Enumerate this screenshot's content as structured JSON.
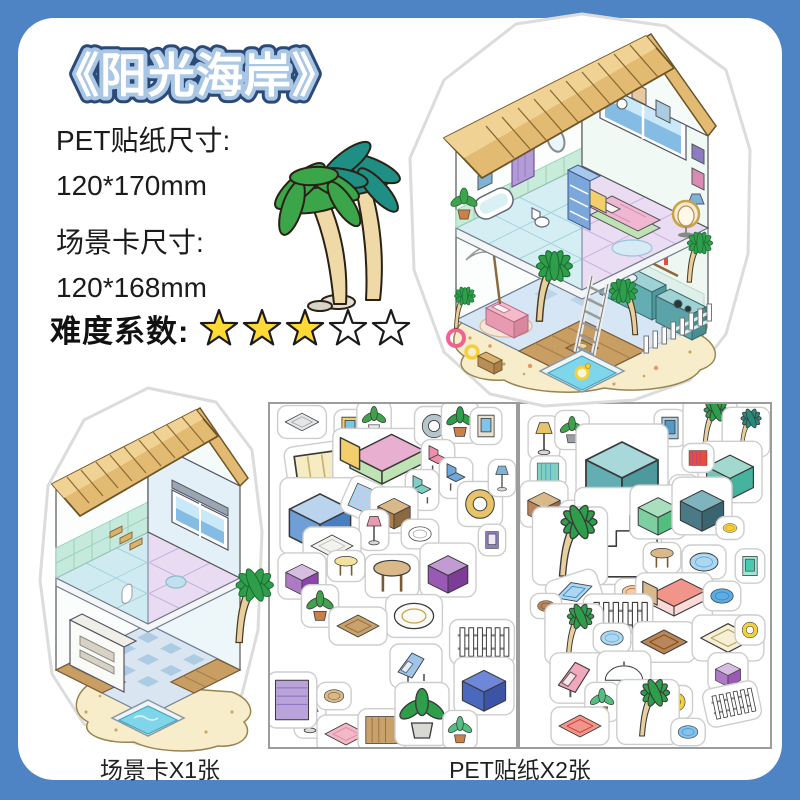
{
  "product": {
    "title": "《阳光海岸》"
  },
  "specs": [
    {
      "label": "PET贴纸尺寸:",
      "value": "120*170mm"
    },
    {
      "label": "场景卡尺寸:",
      "value": "120*168mm"
    }
  ],
  "difficulty": {
    "label": "难度系数:",
    "filled": 3,
    "total": 5
  },
  "captions": {
    "scene_card": "场景卡X1张",
    "stickers": "PET贴纸X2张"
  },
  "colors": {
    "background": "#4E84C3",
    "card": "#FFFFFF",
    "title_fill": "#FFFFFF",
    "title_stroke_dark": "#2C4A78",
    "title_stroke_light": "#A9C6E4",
    "text": "#1B1B1B",
    "star_filled": "#FFD935",
    "star_empty": "#FFFFFF",
    "star_outline": "#1A1A1A",
    "sticker_outline": "#CDCDCD",
    "sand": "#F7EDCB",
    "thatch": "#E2BA72",
    "pool_water": "#7FD6EA",
    "kitchen_teal": "#63AEB3",
    "floor_lavender": "#E9DBF2",
    "floor_cyan": "#CFEAF0"
  },
  "illustrations": {
    "main_house": "isometric-beach-house-sticker",
    "scene_card": "empty-isometric-room-card",
    "palm_deco": "twin-palm-trees"
  },
  "sheets": [
    {
      "name": "sticker-sheet-1",
      "stickers": [
        {
          "n": "hanging-shelf",
          "k": "flat",
          "x": 32,
          "y": 18,
          "s": 0.8,
          "c": [
            "#E4E6E8",
            "#9AA0A6"
          ]
        },
        {
          "n": "picture-frame",
          "k": "frame",
          "x": 80,
          "y": 24,
          "s": 0.9,
          "c": [
            "#F2CF6B",
            "#7FC4E8"
          ]
        },
        {
          "n": "potted-plant",
          "k": "plant",
          "x": 104,
          "y": 16,
          "s": 0.8,
          "c": [
            "#E8E8E4",
            "#3FA34D"
          ]
        },
        {
          "n": "window-blinds",
          "k": "stripes",
          "x": 62,
          "y": 76,
          "s": 1.9,
          "r": -8,
          "c": [
            "#F5ECC4",
            "#C9B270"
          ]
        },
        {
          "n": "double-bed",
          "k": "bed",
          "x": 112,
          "y": 56,
          "s": 1.6,
          "c": [
            "#F2CF6B",
            "#E9AFD0",
            "#BFE3B4"
          ]
        },
        {
          "n": "oval-mirror",
          "k": "ring",
          "x": 164,
          "y": 22,
          "s": 0.9,
          "c": [
            "#B8C4CC"
          ]
        },
        {
          "n": "potted-palm",
          "k": "plant",
          "x": 190,
          "y": 18,
          "s": 0.9,
          "c": [
            "#C9804A",
            "#2E9E4B"
          ]
        },
        {
          "n": "beach-painting",
          "k": "frame",
          "x": 216,
          "y": 22,
          "s": 0.9,
          "c": [
            "#E8E0D0",
            "#7FC4E8"
          ]
        },
        {
          "n": "pink-chair",
          "k": "chair",
          "x": 168,
          "y": 56,
          "s": 0.9,
          "c": [
            "#EE8FAC"
          ]
        },
        {
          "n": "tv-console",
          "k": "box",
          "x": 50,
          "y": 112,
          "s": 1.7,
          "c": [
            "#BBD4EE",
            "#6F9FD8",
            "#4A7EC2"
          ]
        },
        {
          "n": "beach-towels",
          "k": "stripes",
          "x": 96,
          "y": 96,
          "s": 0.8,
          "r": 24,
          "c": [
            "#AFD4F0",
            "#F3B8CC"
          ]
        },
        {
          "n": "kids-chair",
          "k": "chair",
          "x": 152,
          "y": 86,
          "s": 0.9,
          "c": [
            "#7FCFC4"
          ]
        },
        {
          "n": "blue-armchair",
          "k": "chair",
          "x": 186,
          "y": 74,
          "s": 0.9,
          "c": [
            "#6FA8DC"
          ]
        },
        {
          "n": "hanging-egg-chair",
          "k": "ring",
          "x": 210,
          "y": 100,
          "s": 1.1,
          "c": [
            "#E8C36A"
          ]
        },
        {
          "n": "storage-shelf",
          "k": "box",
          "x": 124,
          "y": 106,
          "s": 0.9,
          "c": [
            "#D9B98A",
            "#A87F4D",
            "#8A6A3E"
          ]
        },
        {
          "n": "pink-lamp",
          "k": "lamp",
          "x": 104,
          "y": 126,
          "s": 0.8,
          "c": [
            "#E89BB0"
          ]
        },
        {
          "n": "toilet",
          "k": "round",
          "x": 150,
          "y": 130,
          "s": 0.8,
          "c": [
            "#FFFFFF",
            "#9AA0A6"
          ]
        },
        {
          "n": "white-rug",
          "k": "flat",
          "x": 62,
          "y": 142,
          "s": 1.0,
          "c": [
            "#F2F2EE",
            "#B9BDB9"
          ]
        },
        {
          "n": "wall-art",
          "k": "frame",
          "x": 222,
          "y": 136,
          "s": 0.7,
          "c": [
            "#8E7CC3",
            "#EDE7F6"
          ]
        },
        {
          "n": "blue-lamp",
          "k": "lamp",
          "x": 232,
          "y": 74,
          "s": 0.7,
          "c": [
            "#7FB3D5"
          ]
        },
        {
          "n": "yellow-stool",
          "k": "table",
          "x": 76,
          "y": 162,
          "s": 0.8,
          "c": [
            "#F2E2A0"
          ]
        },
        {
          "n": "round-table",
          "k": "table",
          "x": 122,
          "y": 172,
          "s": 1.3,
          "c": [
            "#D9B98A"
          ]
        },
        {
          "n": "purple-table",
          "k": "box",
          "x": 178,
          "y": 166,
          "s": 1.1,
          "c": [
            "#C39BD3",
            "#9B59B6",
            "#7D3C98"
          ]
        },
        {
          "n": "purple-cabinet",
          "k": "box",
          "x": 32,
          "y": 172,
          "s": 0.9,
          "c": [
            "#D7BDE2",
            "#AF7AC5",
            "#8E44AD"
          ]
        },
        {
          "n": "green-plant",
          "k": "plant",
          "x": 50,
          "y": 202,
          "s": 0.9,
          "c": [
            "#C9804A",
            "#3FA34D"
          ]
        },
        {
          "n": "bathtub",
          "k": "round",
          "x": 144,
          "y": 212,
          "s": 1.4,
          "c": [
            "#FBFBF8",
            "#C9A24A"
          ]
        },
        {
          "n": "wall-shelf-long",
          "k": "flat",
          "x": 88,
          "y": 222,
          "s": 1.0,
          "c": [
            "#C9A26B",
            "#8A6A3E"
          ]
        },
        {
          "n": "garden-fence",
          "k": "fence",
          "x": 212,
          "y": 238,
          "s": 1.1,
          "c": [
            "#FFFFFF"
          ]
        },
        {
          "n": "deck-chair",
          "k": "lounge",
          "x": 146,
          "y": 262,
          "s": 1.0,
          "c": [
            "#9FC5E8"
          ]
        },
        {
          "n": "grand-piano",
          "k": "box",
          "x": 214,
          "y": 282,
          "s": 1.2,
          "c": [
            "#6F87D8",
            "#4A69BD",
            "#3B54A5"
          ]
        },
        {
          "n": "pedestal-sink",
          "k": "lamp",
          "x": 40,
          "y": 312,
          "s": 0.9,
          "c": [
            "#FFFFFF"
          ]
        },
        {
          "n": "purple-curtain",
          "k": "stripes",
          "x": 22,
          "y": 296,
          "s": 1.1,
          "r": 90,
          "c": [
            "#B9A3D8",
            "#8E6FC0"
          ]
        },
        {
          "n": "pink-rug",
          "k": "flat",
          "x": 76,
          "y": 330,
          "s": 1.0,
          "c": [
            "#F2B8C6",
            "#D88AA0"
          ]
        },
        {
          "n": "bookshelf",
          "k": "stripes",
          "x": 112,
          "y": 326,
          "s": 0.9,
          "c": [
            "#C9A26B",
            "#8A6A3E"
          ]
        },
        {
          "n": "large-plant",
          "k": "plant",
          "x": 152,
          "y": 310,
          "s": 1.5,
          "c": [
            "#D9D9D4",
            "#2E9E4B"
          ]
        },
        {
          "n": "small-tree",
          "k": "plant",
          "x": 190,
          "y": 326,
          "s": 0.8,
          "c": [
            "#C9804A",
            "#52BE80"
          ]
        },
        {
          "n": "storage-basket",
          "k": "round",
          "x": 64,
          "y": 292,
          "s": 0.7,
          "c": [
            "#D9B98A",
            "#8A6A3E"
          ]
        }
      ]
    },
    {
      "name": "sticker-sheet-2",
      "stickers": [
        {
          "n": "table-lamp",
          "k": "lamp",
          "x": 24,
          "y": 34,
          "s": 0.9,
          "c": [
            "#E8C36A"
          ]
        },
        {
          "n": "small-plant",
          "k": "plant",
          "x": 52,
          "y": 26,
          "s": 0.8,
          "c": [
            "#9AA0A6",
            "#3FA34D"
          ]
        },
        {
          "n": "bottle-rack",
          "k": "stripes",
          "x": 28,
          "y": 68,
          "s": 0.6,
          "c": [
            "#7FCFC4",
            "#2E86C1"
          ]
        },
        {
          "n": "blue-frame",
          "k": "frame",
          "x": 150,
          "y": 24,
          "s": 0.9,
          "c": [
            "#A9CCE3",
            "#5499C7"
          ]
        },
        {
          "n": "palm-tree-a",
          "k": "palm",
          "x": 190,
          "y": 22,
          "s": 1.0,
          "c": [
            "#E7CF9E",
            "#2E9E4B"
          ]
        },
        {
          "n": "palm-tree-b",
          "k": "palm",
          "x": 226,
          "y": 28,
          "s": 0.85,
          "c": [
            "#E7CF9E",
            "#27897B"
          ]
        },
        {
          "n": "kitchen-counter",
          "k": "box",
          "x": 102,
          "y": 64,
          "s": 2.0,
          "c": [
            "#A8D8DA",
            "#63AEB3",
            "#4E999E"
          ]
        },
        {
          "n": "gray-frame",
          "k": "frame",
          "x": 164,
          "y": 88,
          "s": 0.8,
          "c": [
            "#D5D8DC",
            "#808B96"
          ]
        },
        {
          "n": "teal-sideboard",
          "k": "box",
          "x": 210,
          "y": 68,
          "s": 1.3,
          "c": [
            "#A2D9CE",
            "#73C6B6",
            "#45B39D"
          ]
        },
        {
          "n": "spice-bottles",
          "k": "stripes",
          "x": 178,
          "y": 54,
          "s": 0.5,
          "c": [
            "#E74C3C",
            "#8E44AD"
          ]
        },
        {
          "n": "serving-cart",
          "k": "box",
          "x": 24,
          "y": 100,
          "s": 0.9,
          "c": [
            "#D9B98A",
            "#B9855C",
            "#9A6A44"
          ]
        },
        {
          "n": "wood-crates",
          "k": "flat",
          "x": 66,
          "y": 114,
          "s": 0.9,
          "c": [
            "#D9B36B",
            "#8A6A3E"
          ]
        },
        {
          "n": "staircase",
          "k": "stairs",
          "x": 98,
          "y": 132,
          "s": 1.7,
          "c": [
            "#FFFFFF"
          ]
        },
        {
          "n": "kitchen-stove",
          "k": "box",
          "x": 138,
          "y": 108,
          "s": 1.1,
          "c": [
            "#A9DFBF",
            "#7DCEA0",
            "#52BE80"
          ]
        },
        {
          "n": "refrigerator",
          "k": "box",
          "x": 182,
          "y": 102,
          "s": 1.2,
          "c": [
            "#7FB3BE",
            "#4A7A86",
            "#3A6470"
          ]
        },
        {
          "n": "kettle",
          "k": "round",
          "x": 210,
          "y": 124,
          "s": 0.5,
          "c": [
            "#F4D03F",
            "#B7950B"
          ]
        },
        {
          "n": "tall-palm",
          "k": "palm",
          "x": 50,
          "y": 142,
          "s": 1.5,
          "c": [
            "#E7CF9E",
            "#2E9E4B"
          ]
        },
        {
          "n": "bar-stool",
          "k": "table",
          "x": 142,
          "y": 154,
          "s": 0.8,
          "c": [
            "#D9B98A"
          ]
        },
        {
          "n": "vanity-stool",
          "k": "round",
          "x": 184,
          "y": 158,
          "s": 1.0,
          "c": [
            "#AED6F1",
            "#5DADE2"
          ]
        },
        {
          "n": "mint-frame",
          "k": "frame",
          "x": 230,
          "y": 162,
          "s": 0.8,
          "c": [
            "#A3E4D7",
            "#48C9B0"
          ]
        },
        {
          "n": "surfboard",
          "k": "flat",
          "x": 54,
          "y": 188,
          "s": 0.9,
          "r": -18,
          "c": [
            "#AED6F1",
            "#2E86C1"
          ]
        },
        {
          "n": "pet-bed",
          "k": "round",
          "x": 112,
          "y": 188,
          "s": 0.7,
          "c": [
            "#F5CBA7",
            "#AF601A"
          ]
        },
        {
          "n": "day-bed",
          "k": "bed",
          "x": 154,
          "y": 194,
          "s": 1.2,
          "c": [
            "#D9B98A",
            "#F1948A",
            "#FADBD8"
          ]
        },
        {
          "n": "round-rug",
          "k": "round",
          "x": 202,
          "y": 192,
          "s": 0.8,
          "c": [
            "#5DADE2",
            "#2E86C1"
          ]
        },
        {
          "n": "barrel",
          "k": "round",
          "x": 26,
          "y": 202,
          "s": 0.6,
          "c": [
            "#B9855C",
            "#7E5109"
          ]
        },
        {
          "n": "white-fence",
          "k": "fence",
          "x": 98,
          "y": 214,
          "s": 1.2,
          "c": [
            "#FFFFFF"
          ]
        },
        {
          "n": "beach-palm",
          "k": "palm",
          "x": 54,
          "y": 230,
          "s": 1.1,
          "c": [
            "#E7CF9E",
            "#2E9E4B"
          ]
        },
        {
          "n": "kiddie-pool",
          "k": "round",
          "x": 92,
          "y": 234,
          "s": 0.8,
          "c": [
            "#AED6F1",
            "#5DADE2"
          ]
        },
        {
          "n": "wood-bench",
          "k": "flat",
          "x": 144,
          "y": 238,
          "s": 1.1,
          "c": [
            "#B9855C",
            "#7E5109"
          ]
        },
        {
          "n": "straw-mat",
          "k": "flat",
          "x": 208,
          "y": 234,
          "s": 1.3,
          "c": [
            "#F7F0D5",
            "#B7A86A"
          ]
        },
        {
          "n": "lounge-chair",
          "k": "lounge",
          "x": 60,
          "y": 274,
          "s": 1.2,
          "c": [
            "#F1A7BC"
          ]
        },
        {
          "n": "beach-umbrella",
          "k": "umbrella",
          "x": 104,
          "y": 274,
          "s": 1.1,
          "c": [
            "#FDFEFE"
          ]
        },
        {
          "n": "shrub-plant",
          "k": "plant",
          "x": 82,
          "y": 298,
          "s": 0.8,
          "c": [
            "#C9804A",
            "#52BE80"
          ]
        },
        {
          "n": "duck-float",
          "k": "ring",
          "x": 156,
          "y": 298,
          "s": 0.7,
          "c": [
            "#F4D03F"
          ]
        },
        {
          "n": "pink-mat",
          "k": "flat",
          "x": 60,
          "y": 322,
          "s": 1.0,
          "c": [
            "#F1948A",
            "#C0392B"
          ]
        },
        {
          "n": "potted-palm-tall",
          "k": "palm",
          "x": 128,
          "y": 308,
          "s": 1.2,
          "c": [
            "#E7CF9E",
            "#2E9E4B"
          ]
        },
        {
          "n": "towel-stack",
          "k": "box",
          "x": 208,
          "y": 268,
          "s": 0.7,
          "c": [
            "#D7BDE2",
            "#AF7AC5",
            "#9B59B6"
          ]
        },
        {
          "n": "blue-pouf",
          "k": "round",
          "x": 168,
          "y": 328,
          "s": 0.7,
          "c": [
            "#85C1E9",
            "#3498DB"
          ]
        },
        {
          "n": "pool-ladder",
          "k": "fence",
          "x": 212,
          "y": 300,
          "s": 0.9,
          "r": -12,
          "c": [
            "#FFFFFF"
          ]
        },
        {
          "n": "yellow-float",
          "k": "ring",
          "x": 230,
          "y": 226,
          "s": 0.6,
          "c": [
            "#F4D03F"
          ]
        }
      ]
    }
  ]
}
